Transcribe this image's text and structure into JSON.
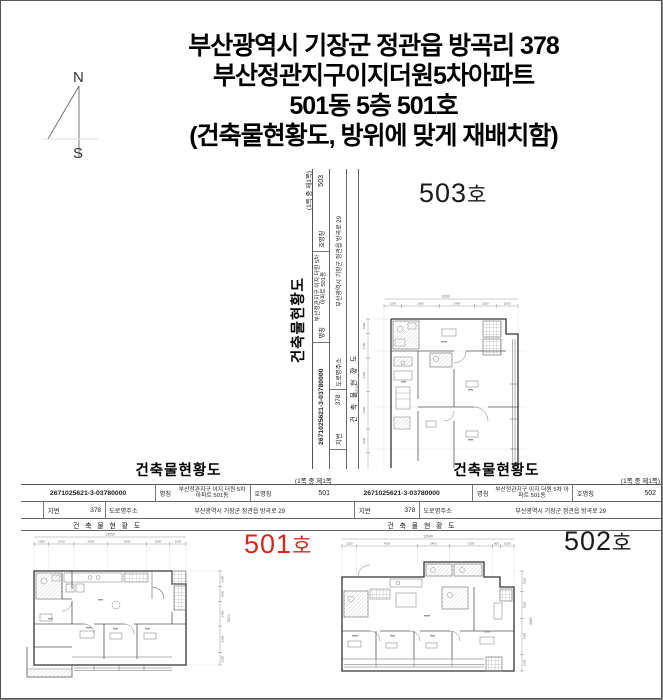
{
  "page_title": {
    "line1": "부산광역시 기장군 정관읍 방곡리 378",
    "line2": "부산정관지구이지더원5차아파트",
    "line3": "501동 5층 501호",
    "line4": "(건축물현황도, 방위에 맞게 재배치함)"
  },
  "compass": {
    "north_label": "N",
    "south_label": "S"
  },
  "document": {
    "form_title": "건축물현황도",
    "page_note": "(1쪽 중 제1쪽)",
    "doc_number": "2671025621-3-03780000",
    "name_label": "명칭",
    "name_value": "부산정관지구 이지 더원 5차 아파트 501동",
    "unit_label": "호명칭",
    "jibun_label": "지번",
    "jibun_value": "378",
    "road_label": "도로명주소",
    "road_value": "부산광역시 기장군 정관읍 방곡로 29",
    "sub_title": "건 축 물 현 황 도"
  },
  "units": {
    "unit501": {
      "number": "501",
      "ho_label_num": "501",
      "ho_suffix": "호",
      "label_color": "#d3291d"
    },
    "unit502": {
      "number": "502",
      "ho_label_num": "502",
      "ho_suffix": "호",
      "label_color": "#1a1a1a"
    },
    "unit503": {
      "number": "503",
      "ho_label_num": "503",
      "ho_suffix": "호",
      "label_color": "#1a1a1a"
    }
  },
  "plans": {
    "plan501": {
      "dims_top_total": "13050",
      "dims_top": [
        "1000",
        "1700",
        "2300",
        "2600",
        "1600",
        "1100"
      ],
      "dims_right": [
        "1500",
        "1500",
        "2400",
        "2600",
        "1200"
      ],
      "dims_right_total": "9200"
    },
    "plan502": {
      "dims_top_total": "12900",
      "dims_top": [
        "1100",
        "4500",
        "2400",
        "3200",
        "600",
        "1000"
      ],
      "dims_right": [
        "1950",
        "2550",
        "3450",
        "1540"
      ],
      "dims_right_total": "9490"
    },
    "plan503": {
      "dims_top_total": "9200",
      "dims_top": [
        "1200",
        "2600",
        "2400",
        "1500",
        "1500"
      ],
      "dims_left": [
        "1000",
        "1700",
        "2300",
        "2600",
        "1600",
        "1100"
      ],
      "dims_left_total": "13050"
    }
  }
}
